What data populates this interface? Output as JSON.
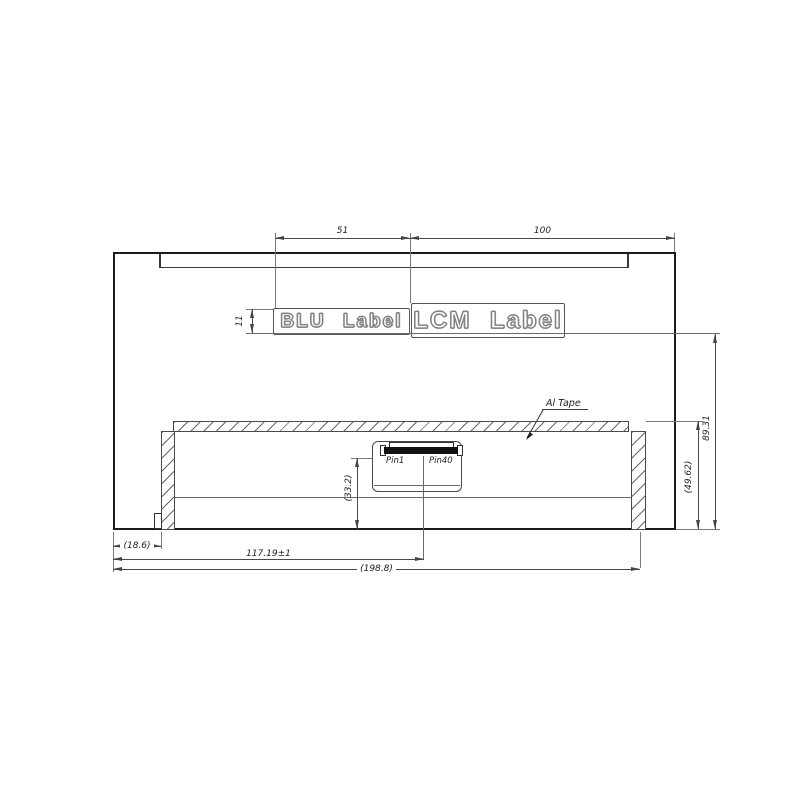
{
  "labels": {
    "blu": "BLU Label",
    "lcm": "LCM Label",
    "al_tape": "Al Tape",
    "pin1": "Pin1",
    "pin40": "Pin40"
  },
  "dimensions": {
    "top_span_left": "51",
    "top_span_right": "100",
    "label_height": "11",
    "height_total": "89.31",
    "height_back": "(49.62)",
    "connector_height": "(33.2)",
    "bottom_offset": "(18.6)",
    "connector_x": "117.19±1",
    "width_total": "(198.8)"
  },
  "colors": {
    "outline": "#1c1c1c",
    "dim_line": "#4a4a4a",
    "hatch": "#666666",
    "background": "#ffffff"
  }
}
